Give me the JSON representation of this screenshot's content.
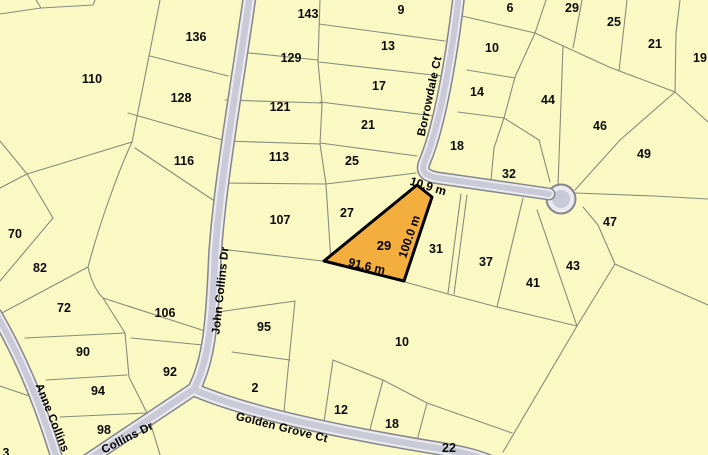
{
  "streets": {
    "john_collins": "John Collins Dr",
    "collins_lower": "Collins Dr",
    "anne_collins": "Anne Collins",
    "golden_grove": "Golden Grove Ct",
    "borrowdale": "Borrowdale Ct"
  },
  "highlight": {
    "lot": "29",
    "frontage": "10.9 m",
    "side": "100.0 m",
    "base": "91.6 m",
    "fill_color": "#f4ae3d",
    "border_color": "#000000"
  },
  "colors": {
    "parcel_fill": "#faf9c4",
    "boundary_line": "#8a8a7c",
    "road_fill": "#c9c9d7",
    "road_edge": "#eaeaee",
    "road_casing": "#85858d",
    "label_text": "#000000"
  },
  "lots": [
    {
      "label": "110",
      "x": 92,
      "y": 83
    },
    {
      "label": "136",
      "x": 196,
      "y": 41
    },
    {
      "label": "128",
      "x": 181,
      "y": 102
    },
    {
      "label": "116",
      "x": 184,
      "y": 165
    },
    {
      "label": "143",
      "x": 308,
      "y": 18
    },
    {
      "label": "129",
      "x": 291,
      "y": 62
    },
    {
      "label": "121",
      "x": 280,
      "y": 111
    },
    {
      "label": "113",
      "x": 279,
      "y": 161
    },
    {
      "label": "107",
      "x": 280,
      "y": 224
    },
    {
      "label": "95",
      "x": 264,
      "y": 331
    },
    {
      "label": "2",
      "x": 255,
      "y": 392
    },
    {
      "label": "9",
      "x": 401,
      "y": 14
    },
    {
      "label": "13",
      "x": 388,
      "y": 50
    },
    {
      "label": "17",
      "x": 379,
      "y": 90
    },
    {
      "label": "21",
      "x": 368,
      "y": 129
    },
    {
      "label": "25",
      "x": 352,
      "y": 165
    },
    {
      "label": "27",
      "x": 347,
      "y": 217
    },
    {
      "label": "6",
      "x": 510,
      "y": 12
    },
    {
      "label": "10",
      "x": 492,
      "y": 52
    },
    {
      "label": "14",
      "x": 477,
      "y": 96
    },
    {
      "label": "18",
      "x": 457,
      "y": 150
    },
    {
      "label": "32",
      "x": 509,
      "y": 178
    },
    {
      "label": "31",
      "x": 436,
      "y": 253
    },
    {
      "label": "37",
      "x": 486,
      "y": 266
    },
    {
      "label": "41",
      "x": 533,
      "y": 287
    },
    {
      "label": "29",
      "x": 572,
      "y": 12
    },
    {
      "label": "25",
      "x": 614,
      "y": 26
    },
    {
      "label": "21",
      "x": 655,
      "y": 48
    },
    {
      "label": "19",
      "x": 700,
      "y": 62
    },
    {
      "label": "44",
      "x": 548,
      "y": 104
    },
    {
      "label": "46",
      "x": 600,
      "y": 130
    },
    {
      "label": "49",
      "x": 644,
      "y": 158
    },
    {
      "label": "47",
      "x": 610,
      "y": 226
    },
    {
      "label": "43",
      "x": 573,
      "y": 270
    },
    {
      "label": "70",
      "x": 15,
      "y": 238
    },
    {
      "label": "82",
      "x": 40,
      "y": 272
    },
    {
      "label": "72",
      "x": 64,
      "y": 312
    },
    {
      "label": "106",
      "x": 165,
      "y": 317
    },
    {
      "label": "90",
      "x": 83,
      "y": 356
    },
    {
      "label": "92",
      "x": 170,
      "y": 376
    },
    {
      "label": "94",
      "x": 98,
      "y": 395
    },
    {
      "label": "98",
      "x": 104,
      "y": 434
    },
    {
      "label": "3",
      "x": 6,
      "y": 457
    },
    {
      "label": "10",
      "x": 402,
      "y": 346
    },
    {
      "label": "12",
      "x": 341,
      "y": 414
    },
    {
      "label": "18",
      "x": 392,
      "y": 428
    },
    {
      "label": "22",
      "x": 449,
      "y": 452
    }
  ]
}
